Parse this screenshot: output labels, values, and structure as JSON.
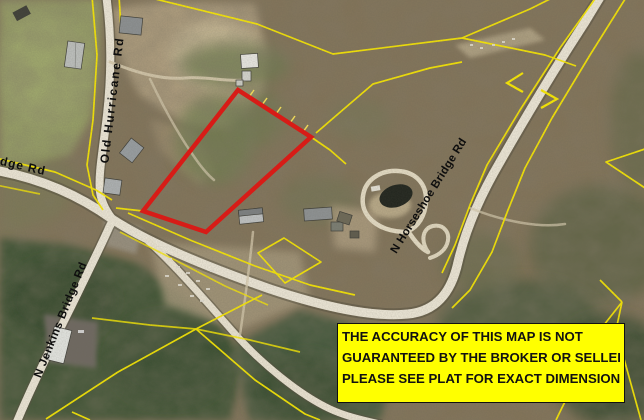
{
  "map": {
    "labels": {
      "old_hurricane": "Old Hurricane Rd",
      "bridge_partial": "dge Rd",
      "n_jenkins": "N Jenkins Bridge Rd",
      "n_horseshoe": "N Horseshoe Bridge Rd"
    },
    "disclaimer": {
      "line1": "THE ACCURACY OF THIS MAP IS NOT",
      "line2": "GUARANTEED BY THE BROKER OR SELLER.",
      "line3": "PLEASE SEE PLAT FOR EXACT DIMENSIONS."
    },
    "colors": {
      "subject_parcel_outline": "#e61410",
      "parcel_boundary_lines": "#ffee00",
      "disclaimer_background": "#ffff00",
      "road_fill": "#f1ebdb"
    }
  }
}
